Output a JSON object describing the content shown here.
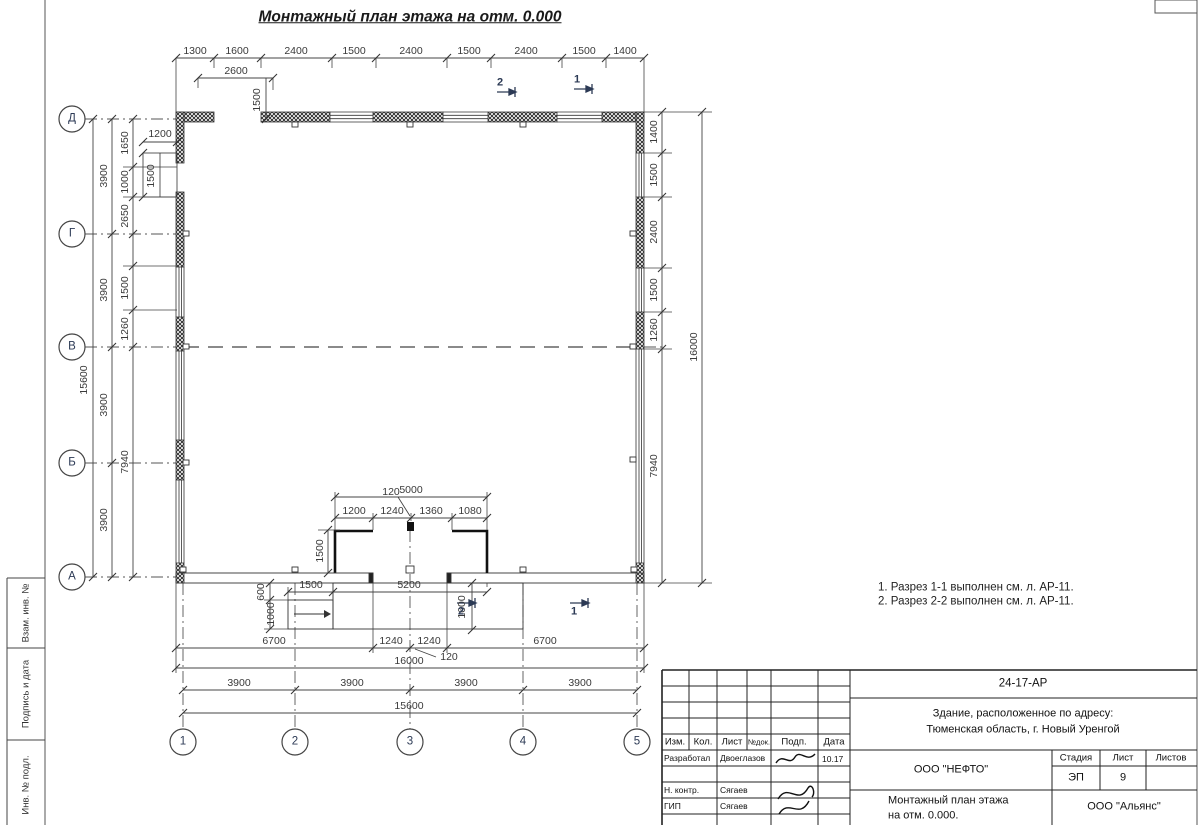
{
  "title": "Монтажный план этажа на отм. 0.000",
  "axes": {
    "rows": [
      "Д",
      "Г",
      "В",
      "Б",
      "А"
    ],
    "cols": [
      "1",
      "2",
      "3",
      "4",
      "5"
    ]
  },
  "sections": {
    "one": "1",
    "two": "2"
  },
  "dims": {
    "top": [
      "1300",
      "1600",
      "2400",
      "1500",
      "2400",
      "1500",
      "2400",
      "1500",
      "1400"
    ],
    "top_canopy": {
      "w": "2600",
      "h": "1500"
    },
    "left": {
      "total": "15600",
      "seg": "3900",
      "chain": [
        "1650",
        "1000",
        "2650",
        "1500",
        "1260",
        "7940"
      ],
      "niche_w": "1200",
      "niche_h": "1500"
    },
    "right": {
      "chain": [
        "1400",
        "1500",
        "2400",
        "1500",
        "1260",
        "7940"
      ],
      "total": "16000"
    },
    "vestibule": {
      "total": "5000",
      "jamb": "120",
      "chain": [
        "1200",
        "1240",
        "1360",
        "1080"
      ],
      "depth": "1500"
    },
    "porch": {
      "ramp_w": "1500",
      "front": "5200",
      "ramp_d1": "600",
      "ramp_d2": "1000",
      "depth": "1600",
      "door_l": "1240",
      "door_r": "1240",
      "jamb": "120"
    },
    "bottom": {
      "six_left": "6700",
      "six_right": "6700",
      "total": "16000",
      "seg": "3900",
      "axes_total": "15600"
    }
  },
  "notes": [
    "1. Разрез 1-1 выполнен см. л. АР-11.",
    "2. Разрез 2-2 выполнен см. л. АР-11."
  ],
  "stamp": {
    "doc_number": "24-17-АР",
    "object_line1": "Здание, расположенное по адресу:",
    "object_line2": "Тюменская область, г. Новый Уренгой",
    "header_cols": [
      "Изм.",
      "Кол.",
      "Лист",
      "№док.",
      "Подп.",
      "Дата"
    ],
    "rows": [
      {
        "role": "Разработал",
        "name": "Двоеглазов",
        "date": "10.17"
      },
      {
        "role": "Н. контр.",
        "name": "Сягаев",
        "date": ""
      },
      {
        "role": "ГИП",
        "name": "Сягаев",
        "date": ""
      }
    ],
    "company": "ООО \"НЕФТО\"",
    "stage_label": "Стадия",
    "sheet_label": "Лист",
    "sheets_label": "Листов",
    "stage": "ЭП",
    "sheet": "9",
    "drawing_name1": "Монтажный план этажа",
    "drawing_name2": "на отм. 0.000.",
    "org": "ООО \"Альянс\""
  },
  "side_strip": [
    "Взам. инв. №",
    "Подпись и дата",
    "Инв. № подл."
  ]
}
